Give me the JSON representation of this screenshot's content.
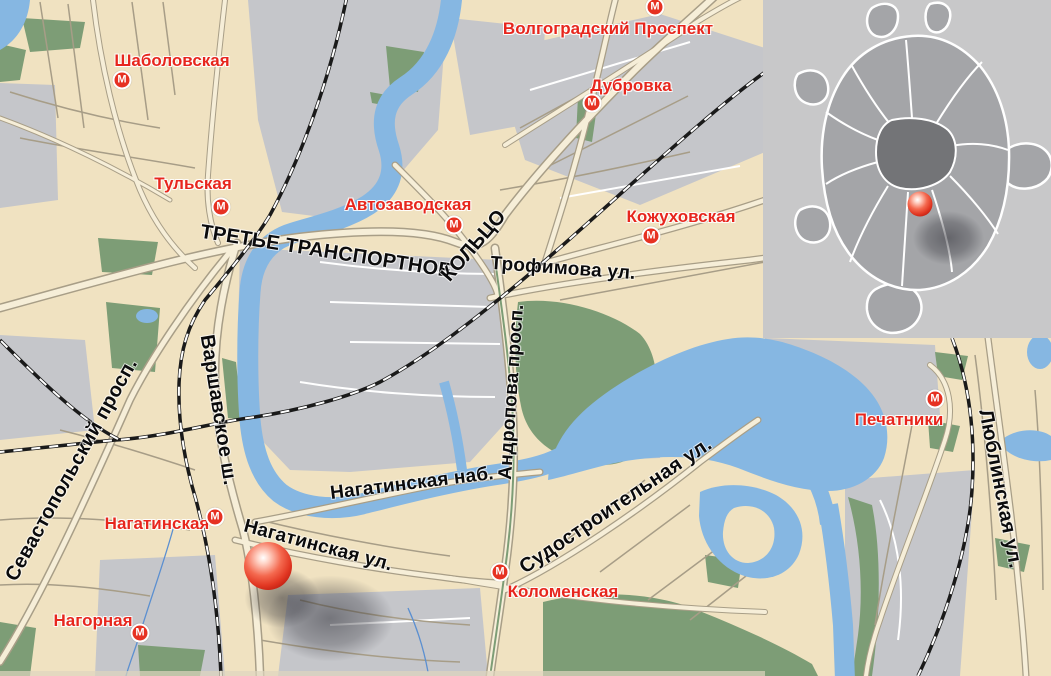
{
  "map": {
    "colors": {
      "block_beige": "#f0e2c1",
      "block_gray": "#c5c6ca",
      "park_green": "#7d9d76",
      "water_blue": "#86b7e2",
      "road_fill": "#f6eed8",
      "road_casing": "#a89e87",
      "railway_black": "#1a1a1a",
      "metro_icon_red": "#e63122",
      "metro_label_red": "#e7261d",
      "street_label_black": "#0b0b0c",
      "inset_background": "#c8c8c9",
      "inset_city_gray": "#a4a5a8",
      "inset_center_gray": "#737477",
      "marker_red": "#e23823"
    },
    "metro_icon_letter": "М",
    "metro_stations": [
      {
        "name": "Шаболовская",
        "icon": {
          "x": 122,
          "y": 80
        },
        "label": {
          "x": 172,
          "y": 61
        }
      },
      {
        "name": "Тульская",
        "icon": {
          "x": 221,
          "y": 207
        },
        "label": {
          "x": 193,
          "y": 184
        }
      },
      {
        "name": "Автозаводская",
        "icon": {
          "x": 454,
          "y": 225
        },
        "label": {
          "x": 408,
          "y": 205
        }
      },
      {
        "name": "Волгоградский Проспект",
        "icon": {
          "x": 655,
          "y": 7
        },
        "label": {
          "x": 608,
          "y": 29
        }
      },
      {
        "name": "Дубровка",
        "icon": {
          "x": 592,
          "y": 103
        },
        "label": {
          "x": 631,
          "y": 86
        }
      },
      {
        "name": "Кожуховская",
        "icon": {
          "x": 651,
          "y": 236
        },
        "label": {
          "x": 681,
          "y": 217
        }
      },
      {
        "name": "Нагатинская",
        "icon": {
          "x": 215,
          "y": 517
        },
        "label": {
          "x": 157,
          "y": 524
        }
      },
      {
        "name": "Нагорная",
        "icon": {
          "x": 140,
          "y": 633
        },
        "label": {
          "x": 93,
          "y": 621
        }
      },
      {
        "name": "Коломенская",
        "icon": {
          "x": 500,
          "y": 572
        },
        "label": {
          "x": 563,
          "y": 592
        }
      },
      {
        "name": "Печатники",
        "icon": {
          "x": 935,
          "y": 399
        },
        "label": {
          "x": 899,
          "y": 420
        }
      }
    ],
    "street_labels": [
      {
        "text": "ТРЕТЬЕ ТРАНСПОРТНОЕ",
        "x": 326,
        "y": 252,
        "rot": 9,
        "size": 20
      },
      {
        "text": "КОЛЬЦО",
        "x": 474,
        "y": 246,
        "rot": -49,
        "size": 20
      },
      {
        "text": "Трофимова ул.",
        "x": 563,
        "y": 269,
        "rot": 4,
        "size": 19
      },
      {
        "text": "Севастопольский просп.",
        "x": 72,
        "y": 470,
        "rot": -61,
        "size": 20
      },
      {
        "text": "Варшавское ш.",
        "x": 218,
        "y": 410,
        "rot": 81,
        "size": 20
      },
      {
        "text": "Нагатинская наб.",
        "x": 412,
        "y": 484,
        "rot": -7,
        "size": 19
      },
      {
        "text": "Андропова просп.",
        "x": 512,
        "y": 392,
        "rot": -86,
        "size": 19
      },
      {
        "text": "Нагатинская ул.",
        "x": 318,
        "y": 546,
        "rot": 15,
        "size": 19
      },
      {
        "text": "Судостроительная ул.",
        "x": 616,
        "y": 506,
        "rot": -34,
        "size": 20
      },
      {
        "text": "Люблинская ул.",
        "x": 1000,
        "y": 489,
        "rot": 79,
        "size": 20
      }
    ],
    "location_marker": {
      "x": 268,
      "y": 566,
      "diameter": 48
    },
    "marker_shadows": [
      {
        "x": 282,
        "y": 598,
        "w": 100,
        "h": 80
      },
      {
        "x": 330,
        "y": 618,
        "w": 170,
        "h": 115
      }
    ],
    "inset": {
      "x": 763,
      "y": 0,
      "width": 288,
      "height": 338,
      "marker": {
        "x": 920,
        "y": 204,
        "diameter": 25
      },
      "shadow": {
        "x": 948,
        "y": 238,
        "w": 95,
        "h": 72
      }
    }
  }
}
